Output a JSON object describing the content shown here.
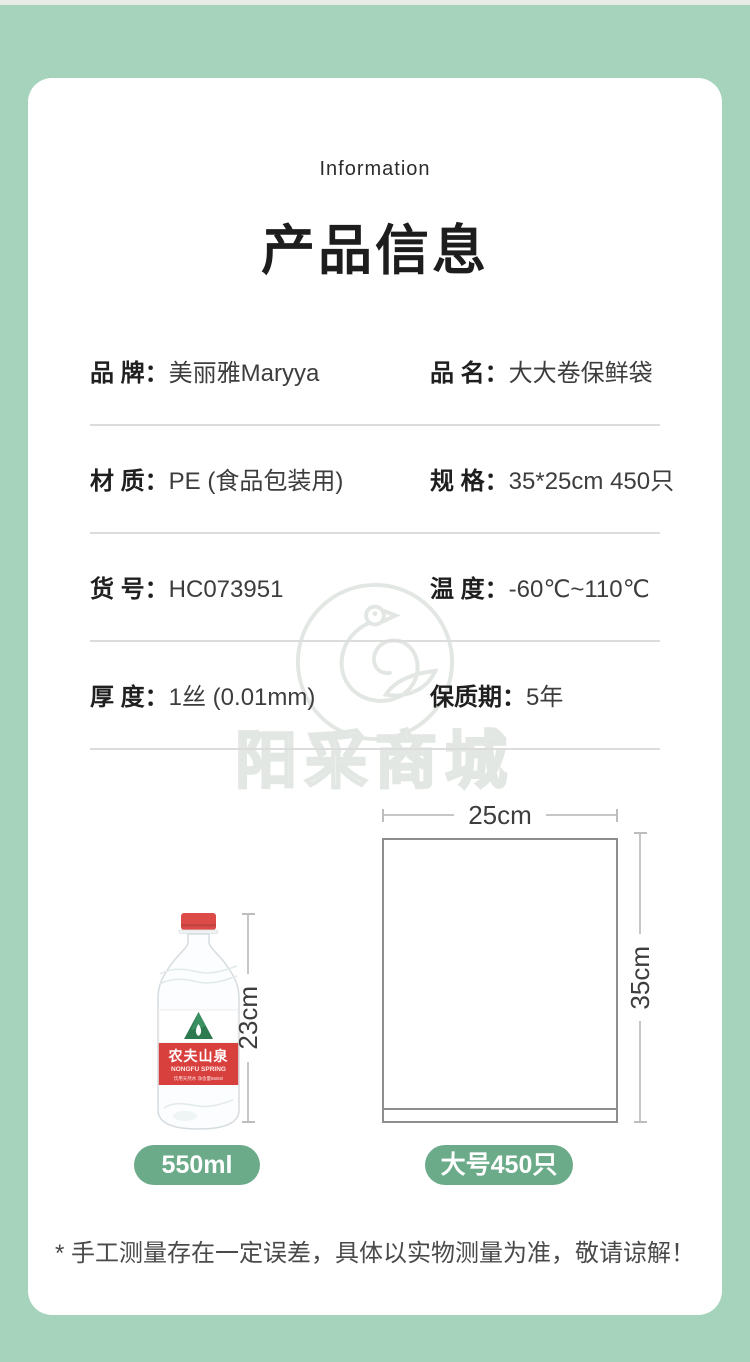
{
  "header": {
    "subtitle": "Information",
    "title": "产品信息"
  },
  "specs": [
    {
      "left": {
        "label": "品 牌：",
        "value": "美丽雅Maryya"
      },
      "right": {
        "label": "品 名：",
        "value": "大大卷保鲜袋"
      }
    },
    {
      "left": {
        "label": "材 质：",
        "value": "PE (食品包装用)"
      },
      "right": {
        "label": "规 格：",
        "value": "35*25cm 450只"
      }
    },
    {
      "left": {
        "label": "货 号：",
        "value": "HC073951"
      },
      "right": {
        "label": "温 度：",
        "value": "-60℃~110℃"
      }
    },
    {
      "left": {
        "label": "厚 度：",
        "value": "1丝 (0.01mm)"
      },
      "right": {
        "label": "保质期：",
        "value": "5年"
      }
    }
  ],
  "watermark": {
    "text": "阳采商城"
  },
  "diagram": {
    "bottle": {
      "brand_cn": "农夫山泉",
      "brand_en": "NONGFU SPRING",
      "sub_line": "饮用天然水 净含量550ml",
      "height_label": "23cm",
      "badge": "550ml"
    },
    "bag": {
      "width_label": "25cm",
      "height_label": "35cm",
      "badge": "大号450只"
    }
  },
  "footnote": "* 手工测量存在一定误差，具体以实物测量为准，敬请谅解！",
  "colors": {
    "background_green": "#a6d3bb",
    "badge_green": "#6cab89",
    "cap_red": "#dd4b49",
    "label_red": "#d8403e",
    "mountain_green": "#2e7a50"
  }
}
